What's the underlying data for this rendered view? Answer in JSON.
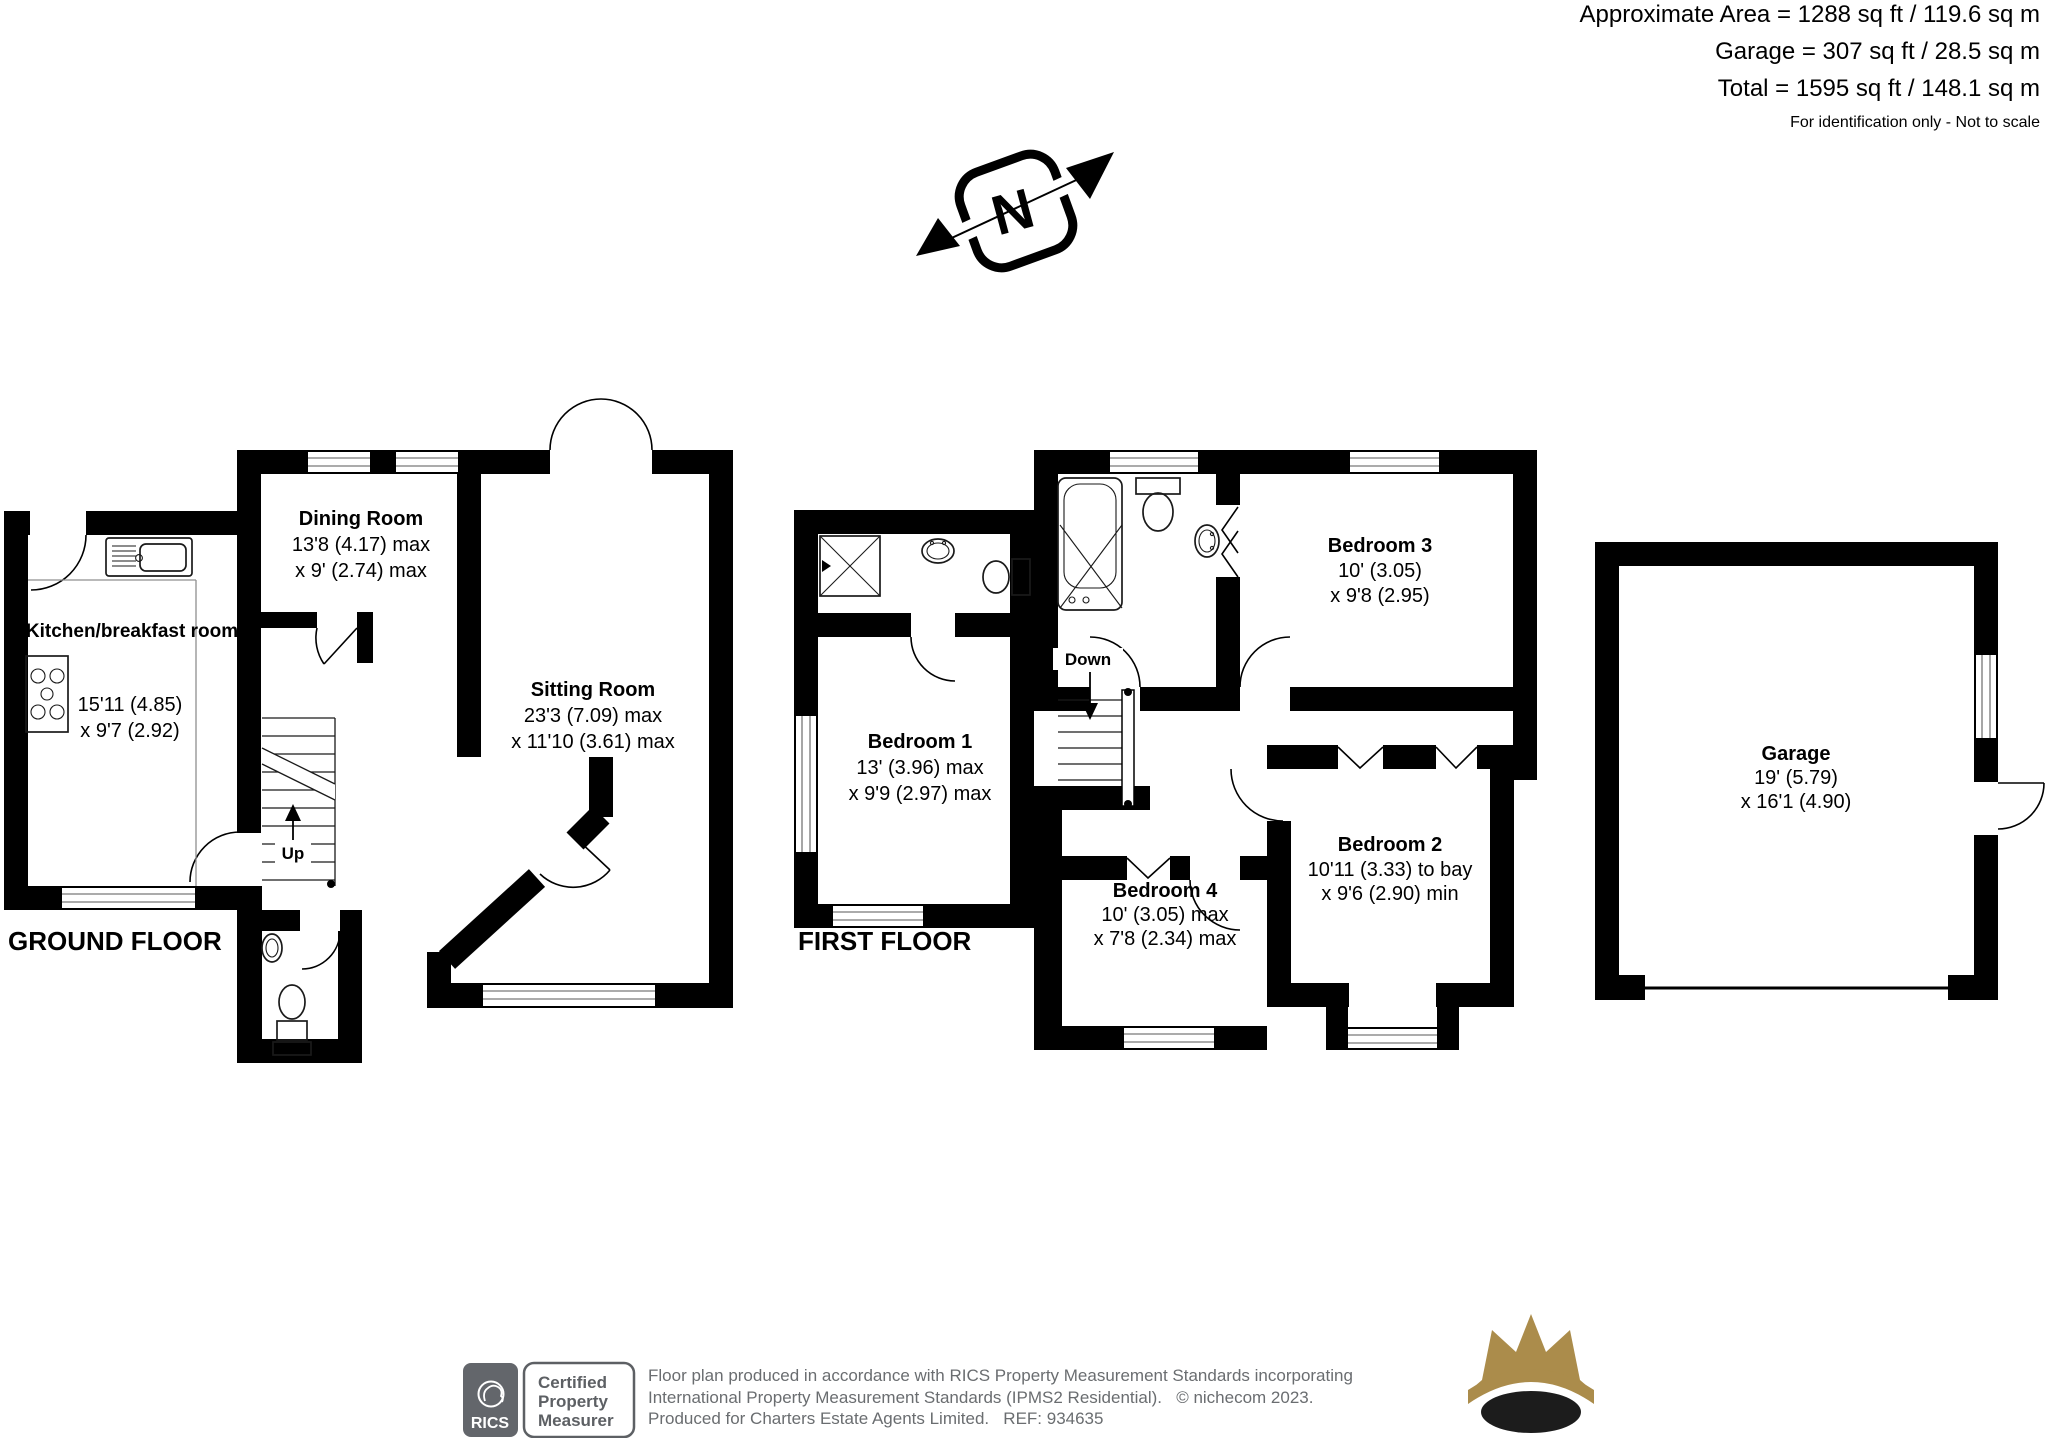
{
  "header": {
    "area_line": "Approximate Area = 1288 sq ft / 119.6 sq m",
    "garage_line": "Garage = 307 sq ft / 28.5 sq m",
    "total_line": "Total = 1595 sq ft / 148.1 sq m",
    "note": "For identification only - Not to scale"
  },
  "compass": {
    "north_label": "N"
  },
  "ground_floor": {
    "label": "GROUND FLOOR",
    "up_label": "Up",
    "rooms": {
      "kitchen": {
        "name": "Kitchen/breakfast room",
        "dim1": "15'11 (4.85)",
        "dim2": "x 9'7 (2.92)"
      },
      "dining": {
        "name": "Dining Room",
        "dim1": "13'8 (4.17) max",
        "dim2": "x 9' (2.74) max"
      },
      "sitting": {
        "name": "Sitting Room",
        "dim1": "23'3 (7.09) max",
        "dim2": "x 11'10 (3.61) max"
      }
    }
  },
  "first_floor": {
    "label": "FIRST FLOOR",
    "down_label": "Down",
    "rooms": {
      "bedroom1": {
        "name": "Bedroom 1",
        "dim1": "13' (3.96) max",
        "dim2": "x 9'9 (2.97) max"
      },
      "bedroom2": {
        "name": "Bedroom 2",
        "dim1": "10'11 (3.33) to bay",
        "dim2": "x 9'6 (2.90) min"
      },
      "bedroom3": {
        "name": "Bedroom 3",
        "dim1": "10' (3.05)",
        "dim2": "x 9'8 (2.95)"
      },
      "bedroom4": {
        "name": "Bedroom 4",
        "dim1": "10' (3.05) max",
        "dim2": "x 7'8 (2.34) max"
      }
    }
  },
  "garage": {
    "name": "Garage",
    "dim1": "19' (5.79)",
    "dim2": "x 16'1 (4.90)"
  },
  "footer": {
    "rics_logo": "RICS",
    "badge_lines": [
      "Certified",
      "Property",
      "Measurer"
    ],
    "disclaimer_lines": [
      "Floor plan produced in accordance with RICS Property Measurement Standards incorporating",
      "International Property Measurement Standards (IPMS2 Residential).   © nichecom 2023.",
      "Produced for Charters Estate Agents Limited.   REF: 934635"
    ]
  },
  "colors": {
    "wall": "#000000",
    "badge_gray": "#63666b",
    "crown_gold": "#ab8c4b"
  }
}
